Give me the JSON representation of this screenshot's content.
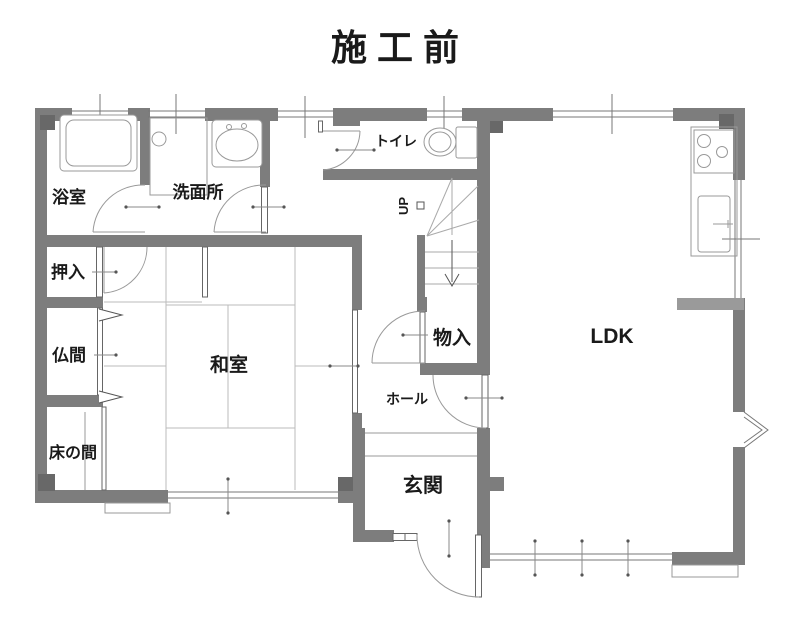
{
  "title": {
    "text": "施工前",
    "color": "#a8641e"
  },
  "rooms": {
    "bathroom": {
      "label": "浴室"
    },
    "washroom": {
      "label": "洗面所"
    },
    "toilet": {
      "label": "トイレ"
    },
    "closet": {
      "label": "押入"
    },
    "butsuma": {
      "label": "仏間"
    },
    "washitsu": {
      "label": "和室"
    },
    "tokonoma": {
      "label": "床の間"
    },
    "storage": {
      "label": "物入"
    },
    "hall": {
      "label": "ホール"
    },
    "entrance": {
      "label": "玄関"
    },
    "ldk": {
      "label": "LDK"
    },
    "stairs": {
      "label": "UP"
    }
  },
  "colors": {
    "wall": "#7d7d7d",
    "pillar": "#686868",
    "counter_bar": "#9a9a9a",
    "thin_line": "#666666",
    "door_arc": "#999999",
    "window_line": "#777777",
    "tatami_line": "#bbbbbb",
    "leader_line": "#888888"
  }
}
